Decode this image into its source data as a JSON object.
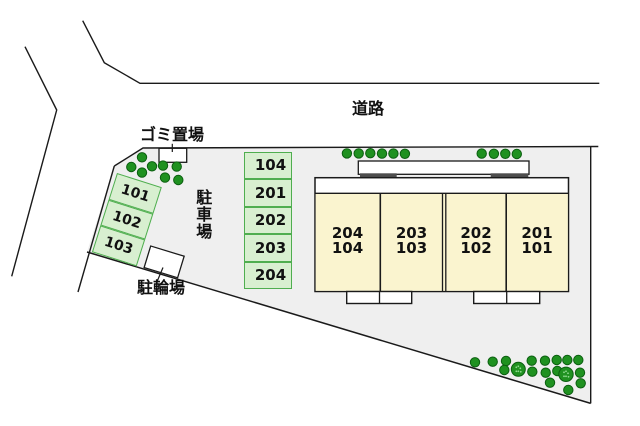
{
  "plan": {
    "road_label": "道路",
    "garbage_area_label": "ゴミ置場",
    "parking_area_label": "駐車場",
    "bicycle_area_label": "駐輪場",
    "angled_stalls": [
      "101",
      "102",
      "103"
    ],
    "column_stalls": [
      "104",
      "201",
      "202",
      "203",
      "204"
    ],
    "units": [
      {
        "upper": "204",
        "lower": "104"
      },
      {
        "upper": "203",
        "lower": "103"
      },
      {
        "upper": "202",
        "lower": "102"
      },
      {
        "upper": "201",
        "lower": "101"
      }
    ],
    "colors": {
      "site_fill": "#efefef",
      "stall_fill": "#d8efd0",
      "stall_border": "#4fae4f",
      "unit_fill": "#faf4cf",
      "tree_fill": "#1f9120",
      "tree_border": "#0b5e10",
      "line": "#1a1a1a"
    }
  }
}
